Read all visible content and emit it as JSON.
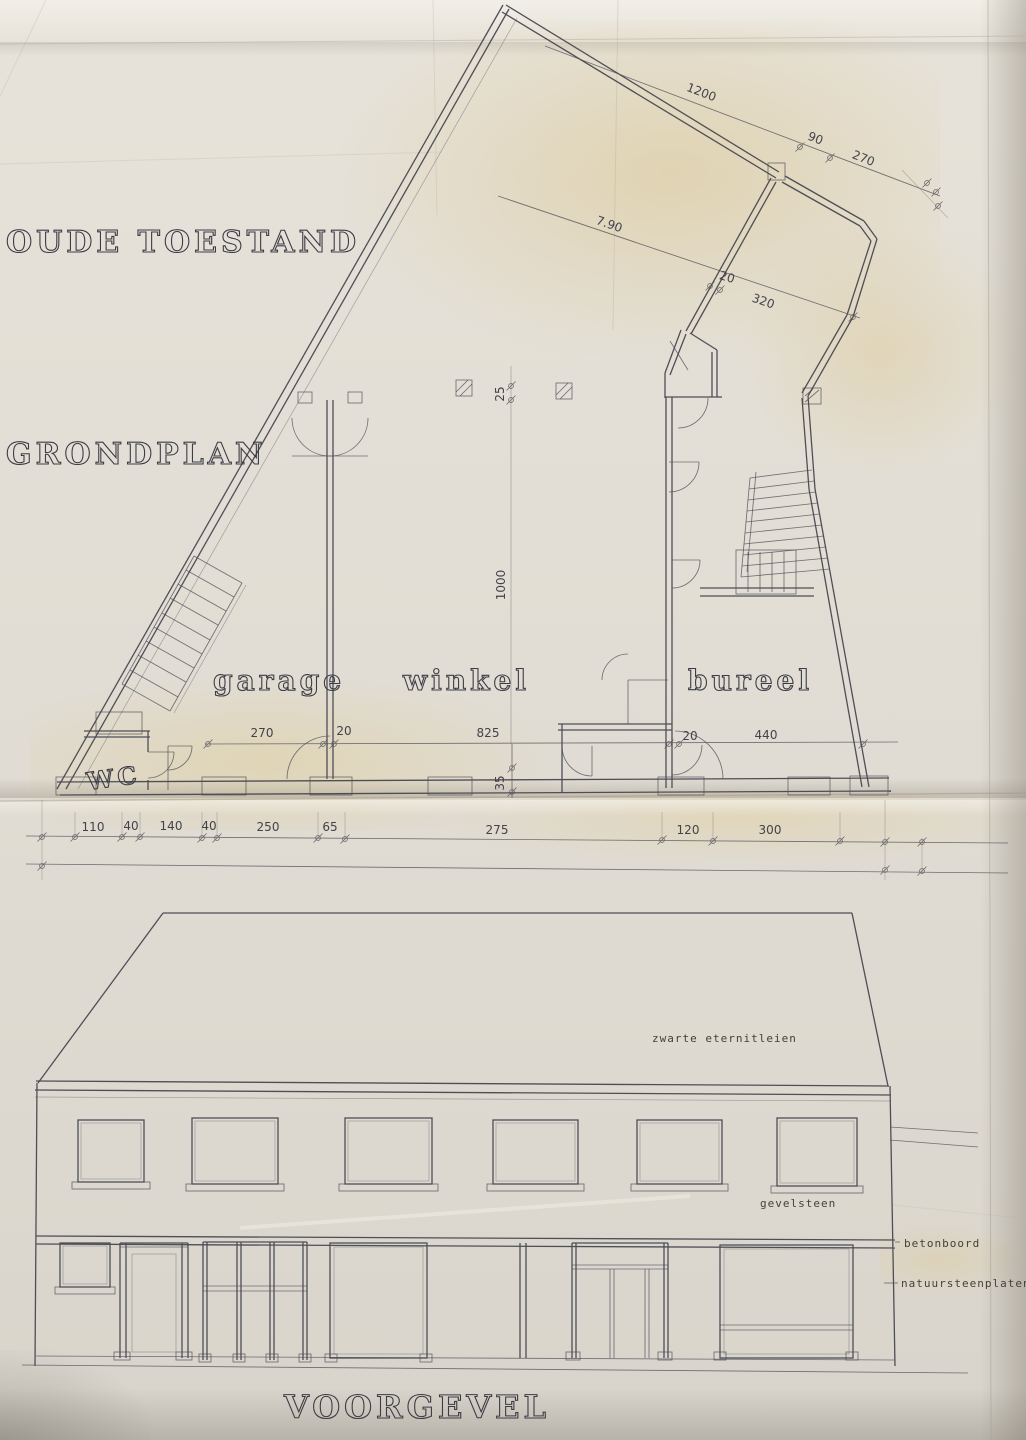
{
  "drawing": {
    "title_state": "OUDE TOESTAND",
    "title_plan": "GRONDPLAN",
    "title_facade": "VOORGEVEL"
  },
  "plan": {
    "room_garage": "garage",
    "room_winkel": "winkel",
    "room_bureel": "bureel",
    "room_wc": "WC",
    "dim_1200": "1200",
    "dim_90": "90",
    "dim_270_top": "270",
    "dim_790": "7.90",
    "dim_20_diag": "20",
    "dim_320": "320",
    "dim_270_int": "270",
    "dim_20_int_a": "20",
    "dim_825": "825",
    "dim_20_int_b": "20",
    "dim_440": "440",
    "dim_25": "25",
    "dim_1000": "1000",
    "dim_35": "35",
    "dims_bottom": [
      "110",
      "40",
      "140",
      "40",
      "250",
      "65",
      "275",
      "120",
      "300"
    ]
  },
  "facade": {
    "anno_roof": "zwarte eternitleien",
    "anno_wall": "gevelsteen",
    "anno_band": "betonboord",
    "anno_plinth": "natuursteenplaten"
  },
  "colors": {
    "paper": "#e3dfd6",
    "ink": "#4e4e57",
    "tint": "#dbc58c"
  }
}
